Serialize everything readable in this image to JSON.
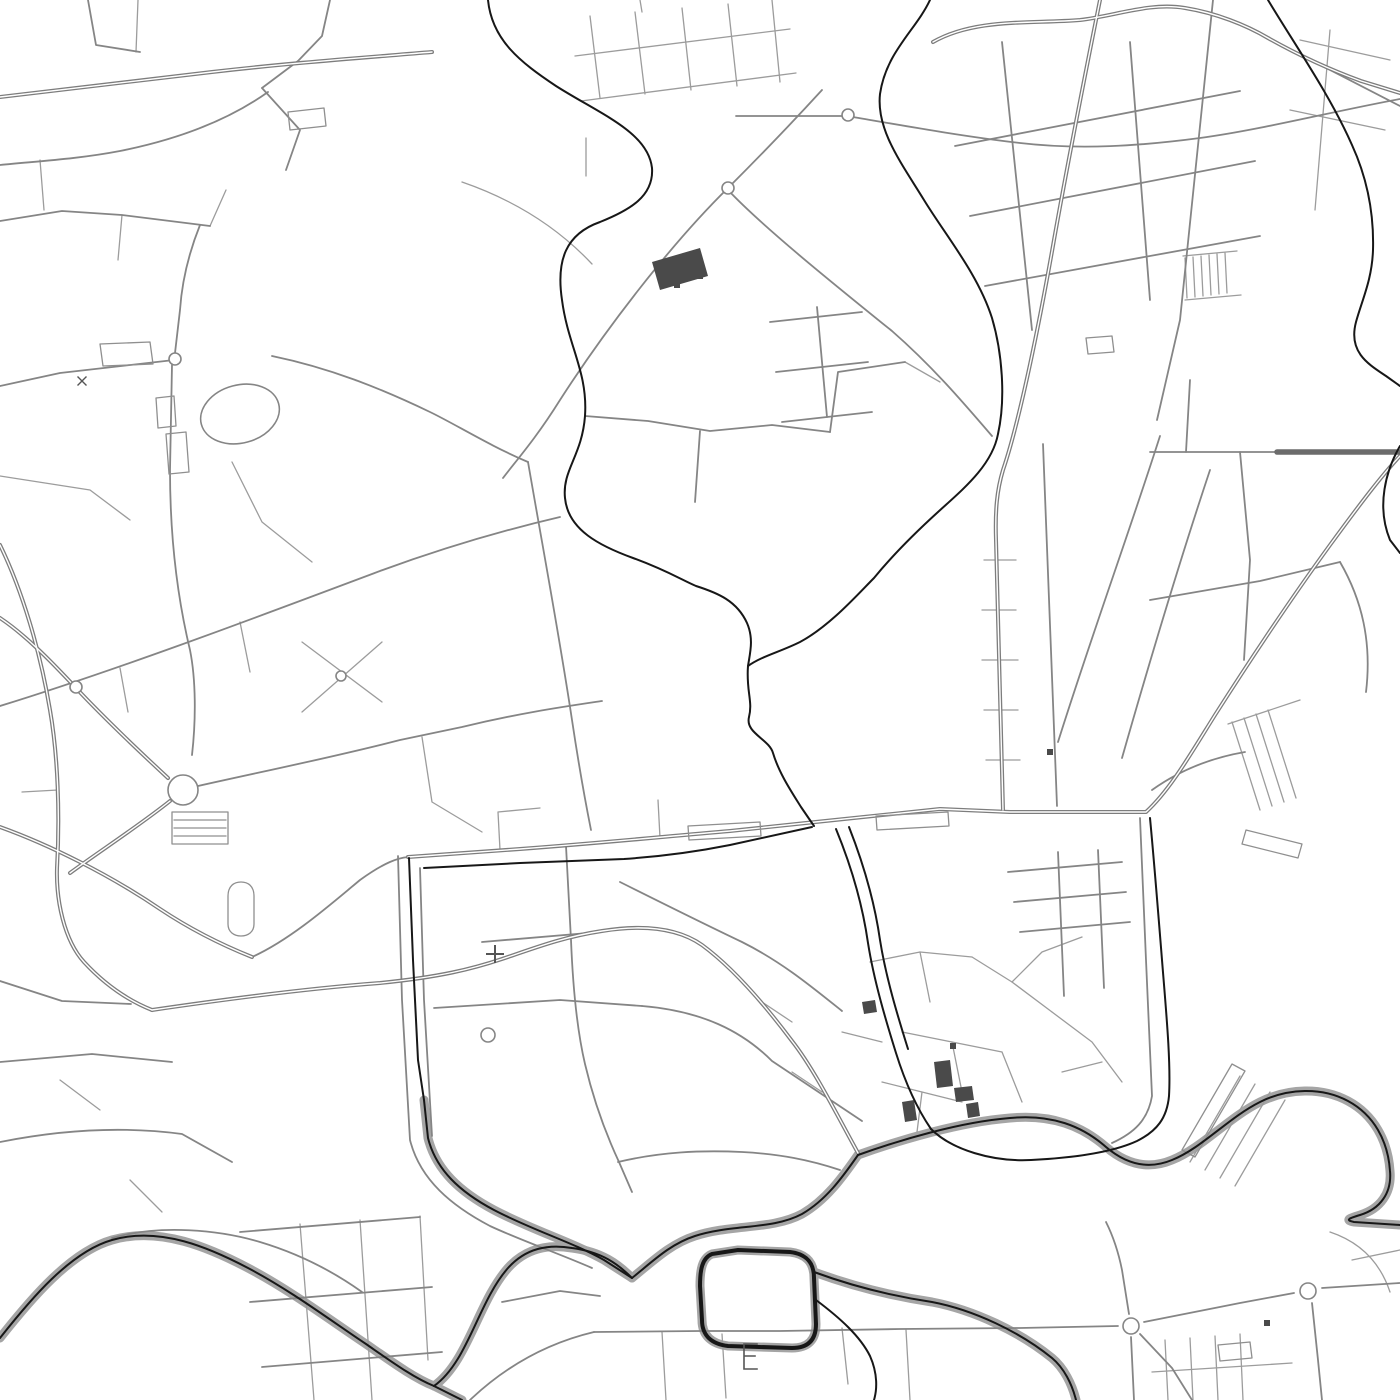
{
  "map": {
    "kind": "street-map",
    "canvas": {
      "width": 1400,
      "height": 1400,
      "background": "#ffffff"
    },
    "palette": {
      "background": "#ffffff",
      "minor_road": "#9c9c9c",
      "medium_road": "#858585",
      "major_road": "#7d7d7d",
      "major_core": "#ffffff",
      "rail": "#6c6c6c",
      "water": "#171717",
      "bank": "#a5a5a5",
      "building": "#4a4a4a",
      "outline": "#8f8f8f"
    },
    "styles": {
      "banks": {
        "color": "bank",
        "width": 9
      },
      "minor": {
        "color": "minor_road",
        "width": 1.3
      },
      "medium": {
        "color": "medium_road",
        "width": 1.8
      },
      "major": {
        "color": "major_road",
        "width": 4.0
      },
      "majorcore": {
        "color": "major_core",
        "width": 1.4
      },
      "rail": {
        "color": "rail",
        "width": 5.5
      },
      "outlines": {
        "color": "outline",
        "width": 1.3
      },
      "water": {
        "color": "water",
        "width": 2.0
      },
      "waterloop": {
        "color": "water",
        "width": 4.0
      },
      "symbols": {
        "color": "medium_road",
        "width": 1.6
      }
    },
    "layers": {
      "banks": [
        "M0,1338 C30,1300 70,1252 112,1240 C160,1226 210,1248 248,1268 C290,1290 330,1320 366,1344 C392,1362 414,1378 434,1386",
        "M434,1386 C468,1362 478,1302 508,1268 C526,1248 548,1244 572,1248 C602,1252 618,1264 632,1278",
        "M632,1278 C652,1262 670,1244 695,1236 C732,1224 772,1230 802,1214 C826,1200 842,1178 858,1155",
        "M858,1155 C900,1140 960,1122 1010,1118 C1052,1114 1082,1126 1106,1147 C1126,1164 1148,1170 1172,1160 C1202,1148 1228,1118 1260,1102 C1288,1088 1322,1087 1348,1101 C1374,1115 1388,1141 1390,1171 C1392,1193 1380,1209 1360,1215 C1350,1218 1344,1220 1354,1222 L1400,1225",
        "M424,1100 L428,1138 C436,1170 460,1192 494,1210 C532,1230 572,1242 604,1260 L632,1278",
        "M738,1250 L712,1254 C702,1258 700,1270 700,1286 L702,1320 C702,1336 712,1344 728,1346 L792,1348 C808,1348 816,1340 816,1324 L814,1278 C814,1262 806,1254 790,1252 Z",
        "M434,1386 L462,1400",
        "M814,1272 C852,1286 892,1296 932,1302 C974,1310 1020,1332 1052,1358 C1064,1368 1072,1384 1076,1400"
      ],
      "minor": [
        "M590,16 L600,98",
        "M635,12 L645,94",
        "M682,8 L691,90",
        "M728,4 L737,86",
        "M772,0 L780,82",
        "M575,56 L790,29",
        "M581,101 L796,73",
        "M210,226 L226,190",
        "M122,215 L118,260",
        "M40,160 L44,210",
        "M138,0 L136,52",
        "M984,560 L1016,560",
        "M982,610 L1016,610",
        "M982,660 L1018,660",
        "M984,710 L1018,710",
        "M986,760 L1020,760",
        "M1185,258 L1187,298",
        "M1193,257 L1195,297",
        "M1201,256 L1203,296",
        "M1209,255 L1211,295",
        "M1217,254 L1219,294",
        "M1225,253 L1227,293",
        "M1183,256 L1237,251",
        "M1185,300 L1241,295",
        "M1190,1162 L1240,1076",
        "M1205,1170 L1255,1084",
        "M1220,1178 L1270,1092",
        "M1235,1186 L1285,1100",
        "M1232,722 L1260,810",
        "M1244,718 L1272,806",
        "M1256,714 L1284,802",
        "M1268,710 L1296,798",
        "M1228,724 L1300,700",
        "M662,1332 L666,1400",
        "M722,1334 L726,1398",
        "M842,1328 L848,1384",
        "M906,1330 L910,1400",
        "M1165,1340 L1168,1400",
        "M1190,1338 L1193,1400",
        "M1215,1336 L1218,1400",
        "M1240,1334 L1243,1400",
        "M1152,1372 L1292,1363",
        "M300,1224 L314,1400",
        "M360,1220 L372,1400",
        "M420,1216 L428,1360",
        "M870,962 L920,952 L972,957",
        "M920,952 L930,1002",
        "M972,957 L1012,982 L1052,1012",
        "M1012,982 L1042,952 L1082,937",
        "M1052,1012 L1092,1042 L1122,1082",
        "M902,1032 L952,1042 L1002,1052",
        "M952,1042 L962,1092",
        "M1002,1052 L1022,1102",
        "M882,1082 L922,1092 L962,1102",
        "M922,1092 L917,1132",
        "M1062,1072 L1102,1062",
        "M842,1032 L882,1042",
        "M792,1072 L822,1092",
        "M762,1002 L792,1022",
        "M232,462 L262,522 L312,562",
        "M302,642 L382,702",
        "M382,642 L302,712",
        "M422,737 L432,802 L482,832",
        "M22,792 L58,790 L58,830",
        "M240,622 L250,672",
        "M120,668 L128,712",
        "M500,850 L498,812 L540,808",
        "M660,838 L658,800",
        "M905,362 L940,382",
        "M60,1080 L100,1110",
        "M130,1180 L162,1212",
        "M1330,1232 C1360,1242 1380,1262 1390,1292",
        "M1352,1260 L1400,1250",
        "M0,476 L90,490 L130,520",
        "M1300,40 L1390,60",
        "M1290,110 L1385,130",
        "M1330,30 L1315,210",
        "M640,0 L642,12",
        "M586,138 L586,176",
        "M462,182 C520,202 562,232 592,264"
      ],
      "medium": [
        "M398,856 L402,1000 L410,1140 C420,1180 452,1206 490,1226 C520,1240 560,1254 592,1268",
        "M420,868 L424,1000 L432,1136",
        "M1140,818 L1146,960 L1152,1096 C1148,1120 1134,1133 1112,1143",
        "M198,786 C260,772 330,758 400,740 L462,727 C520,713 562,707 602,701",
        "M566,846 L571,940 C573,990 577,1030 585,1064 C593,1098 605,1132 619,1162 L632,1192",
        "M736,116 L847,116 C900,125 960,136 1020,143 C1080,150 1140,146 1200,138 C1260,130 1330,112 1400,99",
        "M728,190 C762,226 830,281 892,331 C932,366 962,401 992,436",
        "M822,90 C790,125 760,156 728,188 C670,245 605,330 560,400 C535,440 515,462 503,478",
        "M528,462 C545,560 560,640 572,720 C578,760 585,800 591,830",
        "M1268,38 L1400,106",
        "M1213,0 L1180,320 L1157,420",
        "M272,356 C330,368 380,388 430,412 C455,424 490,446 528,462",
        "M0,386 L60,373 L174,360",
        "M175,353 L180,310 C182,280 190,250 200,225",
        "M172,365 L170,470 C170,540 178,600 190,650 C196,680 196,720 192,755",
        "M268,92 C230,119 180,139 120,151 C78,159 40,161 0,165",
        "M262,88 L300,130 L286,170",
        "M330,0 L322,36 L298,61 L262,88",
        "M88,0 L96,45 L140,52",
        "M0,706 C120,669 260,616 380,571 C440,549 500,531 560,517",
        "M0,221 L62,211 L122,215 L210,226",
        "M434,1008 L560,1000 L642,1006",
        "M482,942 L600,932",
        "M642,1006 C702,1011 742,1031 772,1061 C802,1081 832,1101 862,1121",
        "M620,882 C660,902 700,922 742,942 C782,962 812,987 842,1011",
        "M618,1162 C660,1152 700,1150 742,1152 C780,1154 810,1160 840,1170",
        "M112,1238 C160,1224 220,1230 260,1242 C300,1254 334,1272 362,1292",
        "M594,1332 L700,1331 L780,1331 L900,1329 L1020,1328 L1118,1326",
        "M1131,1337 L1134,1400",
        "M1129,1314 L1122,1270 C1118,1250 1112,1234 1106,1222",
        "M1144,1322 L1240,1303 L1294,1293",
        "M1322,1288 L1400,1283",
        "M1312,1303 L1318,1360 L1322,1400",
        "M1140,1334 L1172,1368 L1192,1400",
        "M470,1400 C510,1362 552,1342 594,1332",
        "M502,1302 L560,1291 L600,1296",
        "M240,1232 L420,1217",
        "M250,1302 L432,1287",
        "M262,1367 L442,1352",
        "M0,981 L62,1001 L131,1004",
        "M0,1062 L92,1054 L172,1062",
        "M0,1142 C60,1130 122,1126 182,1134 L232,1162",
        "M1008,872 L1122,862",
        "M1014,902 L1126,892",
        "M1020,932 L1130,922",
        "M1058,852 L1064,996",
        "M1098,850 L1104,988",
        "M955,146 L1240,91",
        "M970,216 L1255,161",
        "M985,286 L1260,236",
        "M1002,42 L1032,330",
        "M1130,42 L1150,300",
        "M585,416 L648,421 L710,431 L772,425 L830,432",
        "M830,432 L838,372 L905,362",
        "M700,431 L695,502",
        "M770,322 L862,312",
        "M776,372 L868,362",
        "M782,422 L872,412",
        "M817,307 L827,417",
        "M1043,444 C1048,560 1052,680 1057,806",
        "M1160,436 C1130,530 1090,640 1058,742",
        "M1210,470 C1180,560 1150,660 1122,758",
        "M1150,452 L1277,452",
        "M1190,380 L1186,452",
        "M1240,452 L1250,560 L1244,660",
        "M1150,600 L1260,581 L1340,562",
        "M1340,562 C1362,600 1372,642 1366,692",
        "M1152,790 C1180,770 1210,758 1245,752",
        "M252,957 C290,940 330,905 360,880 C385,862 398,858 408,857"
      ],
      "major": [
        "M408,857 L520,849 C600,843 660,837 730,831 L806,823 L940,809 L1010,812 L1146,812 C1170,790 1190,755 1215,715 C1245,668 1290,600 1330,545 C1360,504 1382,475 1400,456",
        "M0,545 C22,590 40,650 50,710 C58,756 60,815 57,868 C56,900 64,940 84,962 C108,988 132,1002 152,1010",
        "M0,618 C24,634 48,658 76,688 C104,718 140,752 168,778",
        "M170,801 C140,825 100,851 70,873",
        "M152,1010 C220,1000 300,989 380,983 C440,977 472,969 502,959 C532,949 562,937 602,931 C652,923 682,931 702,945 C732,967 762,1001 792,1041 C814,1069 836,1113 858,1153",
        "M1100,0 C1088,60 1070,150 1054,240 C1040,320 1020,420 1003,470 C997,490 995,510 996,540 L1003,810",
        "M933,42 C975,18 1030,24 1080,20 C1115,16 1150,2 1185,8 C1216,13 1246,25 1268,38 C1300,56 1331,70 1361,81 L1400,93",
        "M0,97 L212,72 C290,63 360,58 432,52",
        "M0,827 C50,845 110,875 160,909 C190,929 222,945 252,957"
      ],
      "rail": [
        "M1277,452 L1400,452"
      ],
      "outlines": [
        "M100,344 L150,342 L153,364 L103,366 Z",
        "M156,398 L174,396 L176,426 L158,428 Z",
        "M166,434 L186,432 L189,472 L169,474 Z",
        "M228,896 C228,886 234,882 241,882 C248,882 254,886 254,896 L254,924 C254,932 248,936 241,936 C234,936 228,932 228,924 Z",
        "M172,812 L228,812 L228,844 L172,844 Z",
        "M174,820 L226,820",
        "M174,828 L226,828",
        "M174,836 L226,836",
        "M1086,338 L1112,336 L1114,352 L1088,354 Z",
        "M1182,1150 L1232,1064 L1245,1071 L1195,1157 Z",
        "M1246,830 L1302,844 L1298,858 L1242,844 Z",
        "M688,826 L760,822 L761,836 L689,840 Z",
        "M876,816 L948,812 L949,826 L877,830 Z",
        "M288,112 L324,108 L326,126 L290,130 Z",
        "M1218,1345 L1250,1342 L1252,1358 L1220,1361 Z"
      ],
      "water": [
        "M488,0 C492,40 520,62 556,86 C600,114 648,132 652,168 C654,196 630,210 600,222 C566,234 556,260 562,300 C568,346 588,372 585,416 C582,456 562,470 565,498 C568,530 600,546 633,558 C666,570 682,580 696,586 C718,593 737,601 747,623 C754,639 750,653 748,666 C746,691 753,701 749,717 C745,733 769,739 773,753 C779,773 791,791 801,807 L814,826",
        "M930,0 C916,30 886,52 880,94 C876,130 902,164 924,200 C946,236 978,274 992,318 C1002,352 1006,398 998,434 C992,466 962,490 938,512 C916,532 892,556 874,578 C858,594 830,626 800,642 C780,652 762,656 748,666",
        "M1268,0 C1295,45 1330,95 1352,145 C1368,180 1374,215 1373,250 C1372,280 1362,300 1356,322 C1348,352 1368,364 1386,376 L1400,386",
        "M1400,446 C1386,470 1376,506 1390,540 L1400,553",
        "M424,868 L520,863 L624,859 C668,856 700,851 730,845 L812,827",
        "M409,858 L413,960 L418,1060 L424,1100 L428,1138 C436,1170 460,1192 494,1210 C532,1230 572,1242 604,1260 L632,1278",
        "M0,1338 C30,1300 70,1252 112,1240 C160,1226 210,1248 248,1268 C290,1290 330,1320 366,1344 C392,1362 414,1378 434,1386",
        "M434,1386 C468,1362 478,1302 508,1268 C526,1248 548,1244 572,1248 C602,1252 618,1264 632,1278",
        "M434,1386 L462,1400",
        "M632,1278 C652,1262 670,1244 695,1236 C732,1224 772,1230 802,1214 C826,1200 842,1178 858,1155",
        "M836,829 C850,863 862,901 868,943 C874,981 886,1021 896,1053 C906,1085 918,1110 931,1129",
        "M849,827 C862,860 874,898 880,940 C886,978 898,1017 908,1049",
        "M1150,818 C1154,860 1158,910 1162,960 C1166,1010 1171,1062 1169,1096 C1167,1118 1157,1131 1137,1141 C1111,1153 1071,1158 1031,1160 C993,1162 952,1150 931,1129",
        "M858,1155 C900,1140 960,1122 1010,1118 C1052,1114 1082,1126 1106,1147 C1126,1164 1148,1170 1172,1160 C1202,1148 1228,1118 1260,1102 C1288,1088 1322,1087 1348,1101 C1374,1115 1388,1141 1390,1171 C1392,1193 1380,1209 1360,1215 C1350,1218 1344,1220 1354,1222 L1400,1225",
        "M814,1272 C852,1286 892,1296 932,1302 C974,1310 1020,1332 1052,1358 C1064,1368 1072,1384 1076,1400",
        "M816,1300 C840,1318 860,1336 870,1356 C878,1374 877,1390 874,1400"
      ],
      "waterloop": [
        "M738,1250 L712,1254 C702,1258 700,1270 700,1286 L702,1320 C702,1336 712,1344 728,1346 L792,1348 C808,1348 816,1340 816,1324 L814,1278 C814,1262 806,1254 790,1252 Z"
      ],
      "buildings": [
        "M652,262 L700,248 L708,276 L660,290 Z",
        "M934,1062 L950,1060 L953,1086 L937,1088 Z",
        "M954,1088 L972,1086 L974,1100 L956,1102 Z",
        "M902,1102 L914,1100 L917,1120 L905,1122 Z",
        "M862,1002 L875,1000 L877,1012 L864,1014 Z",
        "M966,1104 L978,1102 L980,1116 L968,1118 Z",
        "M674,282 L680,282 L680,288 L674,288 Z",
        "M697,273 L703,273 L703,279 L697,279 Z",
        "M1047,749 L1053,749 L1053,755 L1047,755 Z",
        "M950,1043 L956,1043 L956,1049 L950,1049 Z",
        "M1264,1320 L1270,1320 L1270,1326 L1264,1326 Z"
      ]
    },
    "symbols": {
      "roundabouts": [
        {
          "cx": 183,
          "cy": 790,
          "r": 15
        },
        {
          "cx": 76,
          "cy": 687,
          "r": 6
        },
        {
          "cx": 341,
          "cy": 676,
          "r": 5
        },
        {
          "cx": 175,
          "cy": 359,
          "r": 6
        },
        {
          "cx": 488,
          "cy": 1035,
          "r": 7
        },
        {
          "cx": 728,
          "cy": 188,
          "r": 6
        },
        {
          "cx": 848,
          "cy": 115,
          "r": 6
        },
        {
          "cx": 1131,
          "cy": 1326,
          "r": 8
        },
        {
          "cx": 1308,
          "cy": 1291,
          "r": 8
        }
      ],
      "ellipses": [
        {
          "cx": 240,
          "cy": 414,
          "rx": 40,
          "ry": 29,
          "rotate": -15
        }
      ],
      "cross_marker": "M487,954 L503,954 M495,946 L495,962",
      "pier_comb": "M744,1344 L744,1369 M744,1344 L757,1344 M744,1356 L755,1356 M744,1369 L757,1369",
      "tick_marker": "M78,377 L86,385 M86,377 L78,385"
    }
  }
}
